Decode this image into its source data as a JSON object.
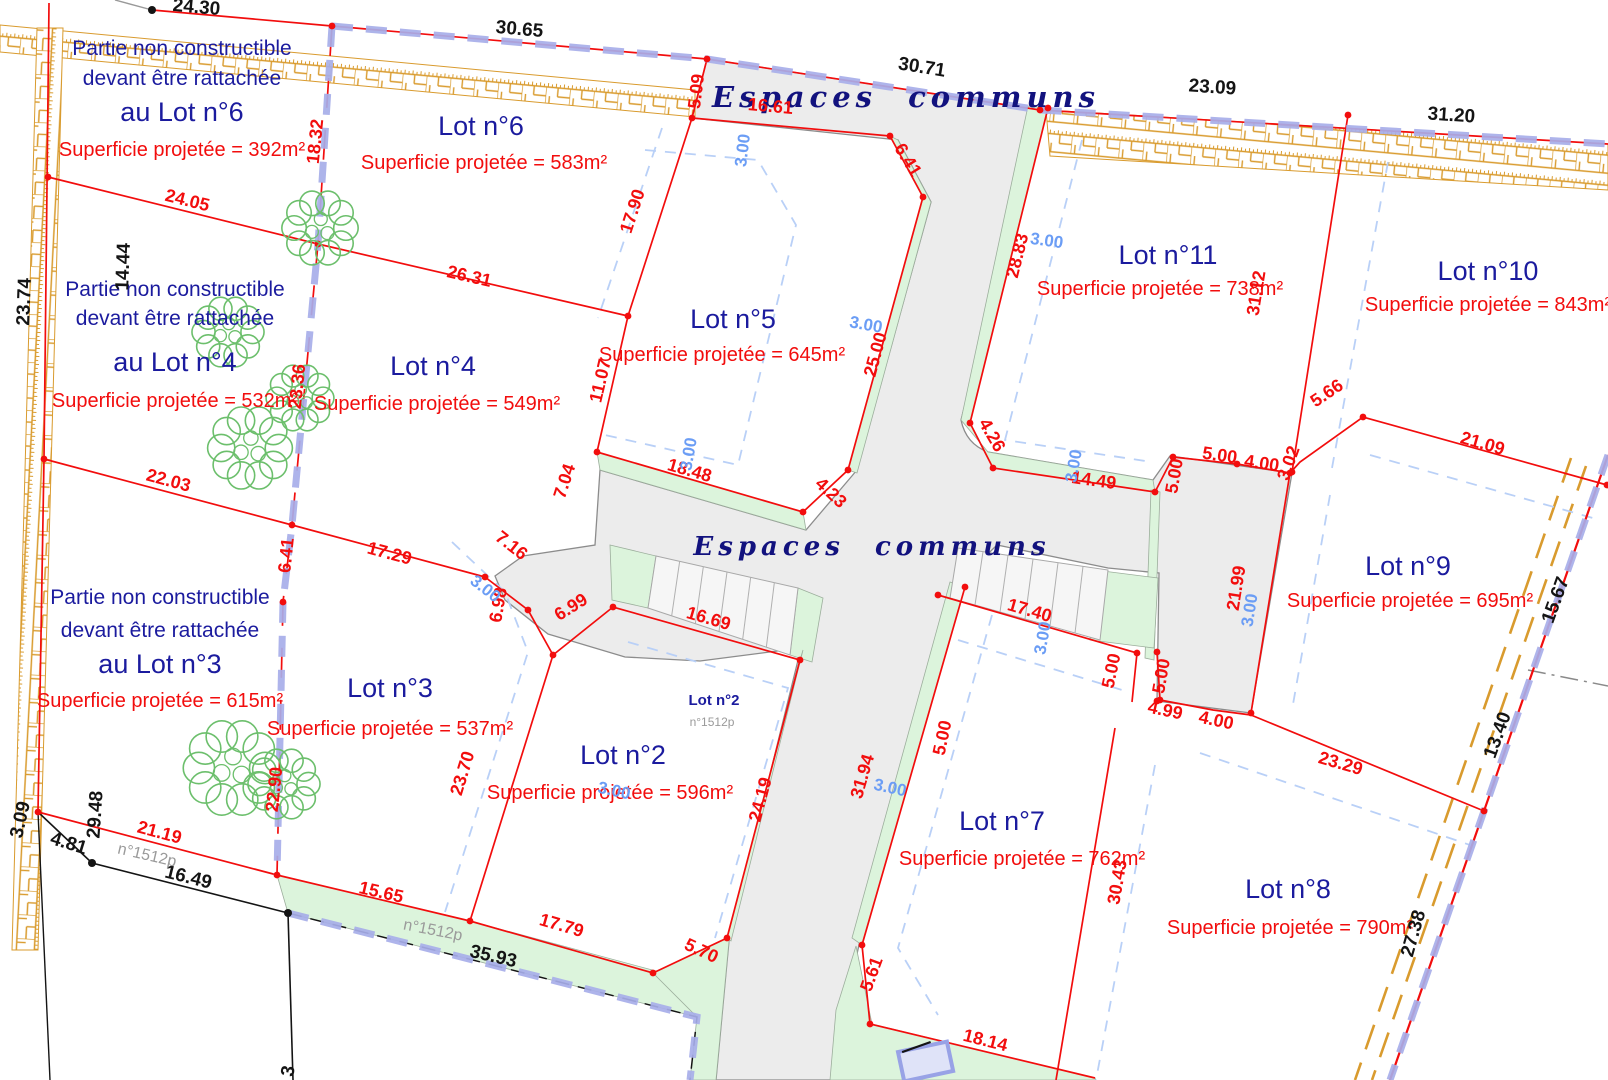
{
  "plan": {
    "espaces_communs_top": "Espaces communs",
    "espaces_communs_center": "Espaces communs",
    "small_lot": {
      "name": "Lot n°2",
      "parcel": "n°1512p"
    },
    "colors": {
      "accent_red": "#f20d0d",
      "navy": "#1b1b9e",
      "dim_blue": "#6b9df5",
      "green_strip": "#dcf4dc",
      "road_gray": "#ececec",
      "hedge_orange": "#d99b2e",
      "boundary_blue": "#a7aee9"
    },
    "lots": [
      {
        "name": "Lot n°6",
        "area": "Superficie projetée = 583m²",
        "nx": 481,
        "ny": 135,
        "ax": 484,
        "ay": 169
      },
      {
        "name": "Lot n°5",
        "area": "Superficie projetée = 645m²",
        "nx": 733,
        "ny": 328,
        "ax": 722,
        "ay": 361
      },
      {
        "name": "Lot n°4",
        "area": "Superficie projetée = 549m²",
        "nx": 433,
        "ny": 375,
        "ax": 437,
        "ay": 410
      },
      {
        "name": "Lot n°3",
        "area": "Superficie projetée = 537m²",
        "nx": 390,
        "ny": 697,
        "ax": 390,
        "ay": 735
      },
      {
        "name": "Lot n°2",
        "area": "Superficie projetée = 596m²",
        "nx": 623,
        "ny": 764,
        "ax": 610,
        "ay": 799
      },
      {
        "name": "Lot n°7",
        "area": "Superficie projetée = 762m²",
        "nx": 1002,
        "ny": 830,
        "ax": 1022,
        "ay": 865
      },
      {
        "name": "Lot n°8",
        "area": "Superficie projetée = 790m²",
        "nx": 1288,
        "ny": 898,
        "ax": 1290,
        "ay": 934
      },
      {
        "name": "Lot n°9",
        "area": "Superficie projetée = 695m²",
        "nx": 1408,
        "ny": 575,
        "ax": 1410,
        "ay": 607
      },
      {
        "name": "Lot n°10",
        "area": "Superficie projetée = 843m²",
        "nx": 1488,
        "ny": 280,
        "ax": 1488,
        "ay": 311
      },
      {
        "name": "Lot n°11",
        "area": "Superficie projetée = 738m²",
        "nx": 1168,
        "ny": 264,
        "ax": 1160,
        "ay": 295
      }
    ],
    "notes": [
      {
        "x": 182,
        "y1": 55,
        "y2": 85,
        "y3": 121,
        "y4": 156,
        "line1": "Partie non constructible",
        "line2": "devant être rattachée",
        "line3": "au Lot n°6",
        "area": "Superficie projetée = 392m²"
      },
      {
        "x": 175,
        "y1": 296,
        "y2": 325,
        "y3": 371,
        "y4": 407,
        "line1": "Partie non constructible",
        "line2": "devant être rattachée",
        "line3": "au Lot n°4",
        "area": "Superficie projetée = 532m²"
      },
      {
        "x": 160,
        "y1": 604,
        "y2": 637,
        "y3": 673,
        "y4": 707,
        "line1": "Partie non constructible",
        "line2": "devant être rattachée",
        "line3": "au Lot n°3",
        "area": "Superficie projetée = 615m²"
      }
    ],
    "dims_red": [
      {
        "t": "5.09",
        "x": 702,
        "y": 92,
        "r": -83
      },
      {
        "t": "16.61",
        "x": 770,
        "y": 112,
        "r": 5
      },
      {
        "t": "6.41",
        "x": 903,
        "y": 163,
        "r": 58
      },
      {
        "t": "17.90",
        "x": 638,
        "y": 213,
        "r": -72
      },
      {
        "t": "11.07",
        "x": 606,
        "y": 382,
        "r": -77
      },
      {
        "t": "18.32",
        "x": 321,
        "y": 142,
        "r": -84
      },
      {
        "t": "24.05",
        "x": 186,
        "y": 206,
        "r": 14
      },
      {
        "t": "26.31",
        "x": 468,
        "y": 282,
        "r": 13
      },
      {
        "t": "23.36",
        "x": 303,
        "y": 387,
        "r": -84
      },
      {
        "t": "22.03",
        "x": 167,
        "y": 486,
        "r": 15
      },
      {
        "t": "17.29",
        "x": 388,
        "y": 559,
        "r": 15
      },
      {
        "t": "6.41",
        "x": 292,
        "y": 556,
        "r": -84
      },
      {
        "t": "22.90",
        "x": 280,
        "y": 790,
        "r": -84
      },
      {
        "t": "7.04",
        "x": 570,
        "y": 483,
        "r": -72
      },
      {
        "t": "7.16",
        "x": 508,
        "y": 550,
        "r": 38
      },
      {
        "t": "6.98",
        "x": 504,
        "y": 606,
        "r": -80
      },
      {
        "t": "6.99",
        "x": 574,
        "y": 612,
        "r": -32
      },
      {
        "t": "18.48",
        "x": 688,
        "y": 476,
        "r": 16
      },
      {
        "t": "4.23",
        "x": 827,
        "y": 497,
        "r": 43
      },
      {
        "t": "25.00",
        "x": 881,
        "y": 356,
        "r": -75
      },
      {
        "t": "16.69",
        "x": 707,
        "y": 624,
        "r": 16
      },
      {
        "t": "23.70",
        "x": 468,
        "y": 775,
        "r": -73
      },
      {
        "t": "21.19",
        "x": 158,
        "y": 838,
        "r": 15
      },
      {
        "t": "15.65",
        "x": 380,
        "y": 898,
        "r": 13
      },
      {
        "t": "17.79",
        "x": 560,
        "y": 931,
        "r": 16
      },
      {
        "t": "5.70",
        "x": 699,
        "y": 956,
        "r": 25
      },
      {
        "t": "24.19",
        "x": 766,
        "y": 801,
        "r": -75
      },
      {
        "t": "31.94",
        "x": 868,
        "y": 778,
        "r": -74
      },
      {
        "t": "5.61",
        "x": 877,
        "y": 976,
        "r": -70
      },
      {
        "t": "18.14",
        "x": 984,
        "y": 1046,
        "r": 14
      },
      {
        "t": "28.83",
        "x": 1023,
        "y": 257,
        "r": -76
      },
      {
        "t": "4.26",
        "x": 987,
        "y": 438,
        "r": 60
      },
      {
        "t": "14.49",
        "x": 1093,
        "y": 486,
        "r": 8
      },
      {
        "t": "31.12",
        "x": 1262,
        "y": 294,
        "r": -81
      },
      {
        "t": "5.00",
        "x": 1180,
        "y": 477,
        "r": -80
      },
      {
        "t": "5.00",
        "x": 1219,
        "y": 461,
        "r": 8
      },
      {
        "t": "4.00",
        "x": 1261,
        "y": 469,
        "r": 8
      },
      {
        "t": "3.02",
        "x": 1294,
        "y": 465,
        "r": -70
      },
      {
        "t": "5.66",
        "x": 1330,
        "y": 398,
        "r": -34
      },
      {
        "t": "21.09",
        "x": 1481,
        "y": 449,
        "r": 16
      },
      {
        "t": "21.99",
        "x": 1242,
        "y": 589,
        "r": -81
      },
      {
        "t": "5.00",
        "x": 1117,
        "y": 672,
        "r": -78
      },
      {
        "t": "5.00",
        "x": 1167,
        "y": 677,
        "r": -80
      },
      {
        "t": "5.00",
        "x": 948,
        "y": 739,
        "r": -78
      },
      {
        "t": "4.99",
        "x": 1164,
        "y": 716,
        "r": 12
      },
      {
        "t": "4.00",
        "x": 1215,
        "y": 726,
        "r": 12
      },
      {
        "t": "17.40",
        "x": 1028,
        "y": 616,
        "r": 16
      },
      {
        "t": "30.43",
        "x": 1123,
        "y": 883,
        "r": -80
      },
      {
        "t": "23.29",
        "x": 1339,
        "y": 769,
        "r": 16
      }
    ],
    "dims_black": [
      {
        "t": "24.30",
        "x": 196,
        "y": 13,
        "r": 5
      },
      {
        "t": "30.65",
        "x": 519,
        "y": 35,
        "r": 5
      },
      {
        "t": "30.71",
        "x": 921,
        "y": 73,
        "r": 9
      },
      {
        "t": "23.09",
        "x": 1212,
        "y": 93,
        "r": 4
      },
      {
        "t": "31.20",
        "x": 1451,
        "y": 121,
        "r": 4
      },
      {
        "t": "14.44",
        "x": 129,
        "y": 267,
        "r": -88
      },
      {
        "t": "23.74",
        "x": 30,
        "y": 302,
        "r": -88
      },
      {
        "t": "29.48",
        "x": 101,
        "y": 815,
        "r": -86
      },
      {
        "t": "3.09",
        "x": 26,
        "y": 821,
        "r": -77
      },
      {
        "t": "4.81",
        "x": 67,
        "y": 849,
        "r": 17
      },
      {
        "t": "16.49",
        "x": 187,
        "y": 883,
        "r": 14
      },
      {
        "t": "35.93",
        "x": 492,
        "y": 962,
        "r": 13
      },
      {
        "t": "15.67",
        "x": 1561,
        "y": 602,
        "r": -70
      },
      {
        "t": "13.40",
        "x": 1503,
        "y": 737,
        "r": -70
      },
      {
        "t": "27.38",
        "x": 1419,
        "y": 935,
        "r": -74
      },
      {
        "t": "3",
        "x": 294,
        "y": 1072,
        "r": -80
      }
    ],
    "dims_blue": [
      {
        "t": "3.00",
        "x": 748,
        "y": 151,
        "r": -83
      },
      {
        "t": "3.00",
        "x": 1046,
        "y": 246,
        "r": 8
      },
      {
        "t": "3.00",
        "x": 865,
        "y": 330,
        "r": 10
      },
      {
        "t": "3.00",
        "x": 694,
        "y": 455,
        "r": -80
      },
      {
        "t": "3.00",
        "x": 482,
        "y": 593,
        "r": 38
      },
      {
        "t": "3.00",
        "x": 1079,
        "y": 467,
        "r": -80
      },
      {
        "t": "3.00",
        "x": 1255,
        "y": 611,
        "r": -81
      },
      {
        "t": "3.00",
        "x": 1048,
        "y": 639,
        "r": -80
      },
      {
        "t": "3.00",
        "x": 889,
        "y": 793,
        "r": 12
      },
      {
        "t": "3.00",
        "x": 613,
        "y": 796,
        "r": 12
      }
    ],
    "labels_gray": [
      {
        "t": "n°1512p",
        "x": 146,
        "y": 860,
        "r": 13
      },
      {
        "t": "n°1512p",
        "x": 432,
        "y": 935,
        "r": 11
      }
    ]
  }
}
